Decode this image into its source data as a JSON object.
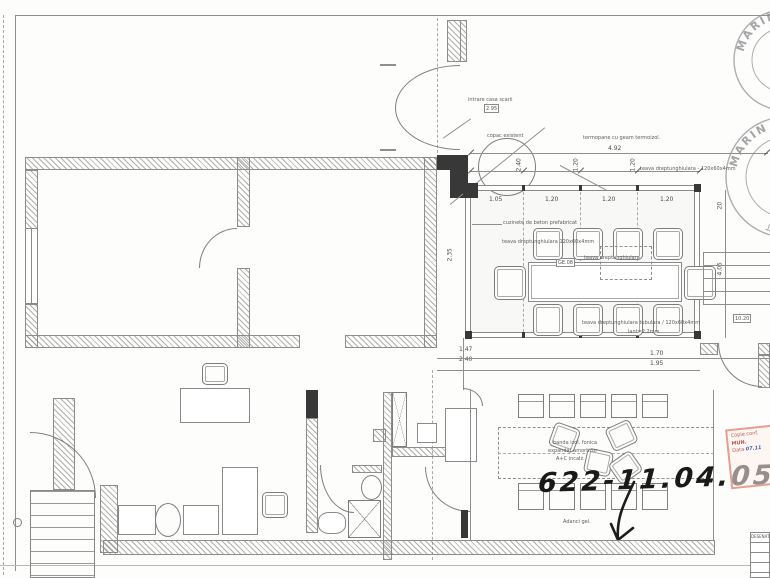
{
  "drawing": {
    "handwritten_note": "622-11.04.05",
    "annotations": {
      "entrance": "intrare casa scarii",
      "entrance_tag": "2.95",
      "tree": "copac existent",
      "glazing": "termopane cu geam termoizol.",
      "beam_top_right": "teava dreptunghiulara - 120x60x4mm",
      "footing": "cuzinete de beton prefabricat",
      "beam_left": "teava dreptunghiulara 120x60x4mm",
      "beam_mid": "teava dreptunghiulara",
      "beam_bottom": "teava dreptunghiulara tubulara / 120x60x4mm",
      "beam_bottom_sub": "lant=2.2mm",
      "table_tag": "GE.08",
      "terrace_tag": "10.20",
      "office_note_1": "banda izol. fonica",
      "office_note_2": "expandat amortizor",
      "office_note_3": "A+C incalz.",
      "office_note_4": "Adanci gel."
    },
    "dimensions": {
      "top_overall": "4.92",
      "pair_a": "2.40",
      "pair_b": "1.20",
      "pair_c": "1.20",
      "inner": [
        "1.05",
        "1.20",
        "1.20",
        "1.20"
      ],
      "below_left": [
        "1.47",
        "2.40"
      ],
      "below_right": [
        "1.70",
        "1.95"
      ],
      "right_vert": "4.05",
      "right_vert_top": "20",
      "left_vert": "2.35"
    },
    "stamps": {
      "round_top_text": "MARIN A.",
      "round_bottom_text_1": "MARIN A.",
      "round_bottom_text_2": "VERIFICAT"
    },
    "approval_stamp": {
      "line1": "Copie conf.",
      "line2": "MUN.",
      "line3_label": "Data",
      "line3_value": "07.11"
    },
    "title_block": {
      "label": "DESENAT"
    }
  }
}
